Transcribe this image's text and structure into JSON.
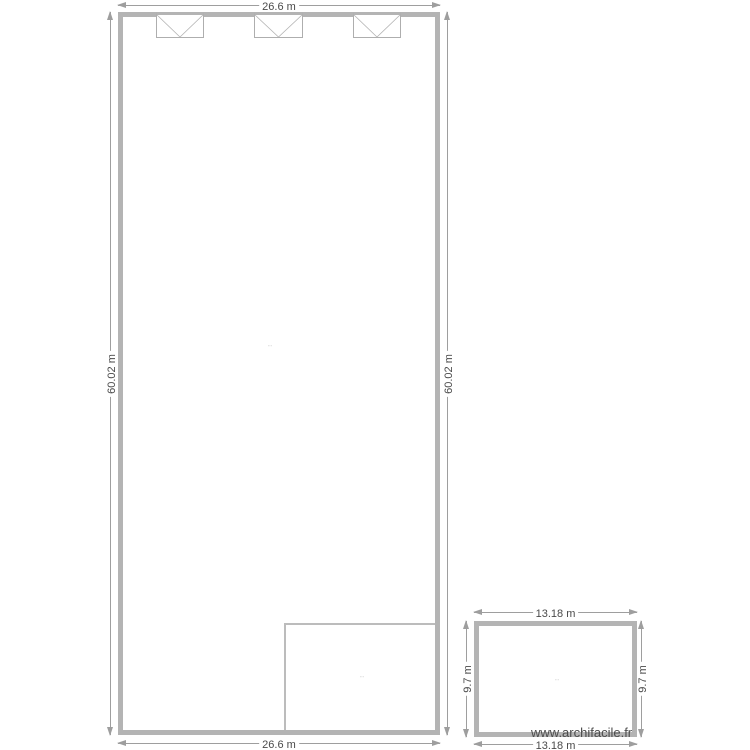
{
  "plan": {
    "watermark": "www.archifacile.fr",
    "main_room": {
      "width_label": "26.6 m",
      "height_label": "60.02 m",
      "area_label": "···",
      "window_count": 3
    },
    "inner_room": {
      "area_label": "···"
    },
    "annex_room": {
      "width_label": "13.18 m",
      "height_label": "9.7 m",
      "area_label": "···"
    },
    "dimensions": {
      "main_top": "26.6 m",
      "main_bottom": "26.6 m",
      "main_left": "60.02 m",
      "main_right": "60.02 m",
      "annex_top": "13.18 m",
      "annex_bottom": "13.18 m",
      "annex_left": "9.7 m",
      "annex_right": "9.7 m"
    },
    "colors": {
      "wall": "#b4b4b4",
      "dimension": "#9e9e9e",
      "label_text": "#4a4a4a",
      "watermark_text": "#4d4d4d"
    }
  }
}
